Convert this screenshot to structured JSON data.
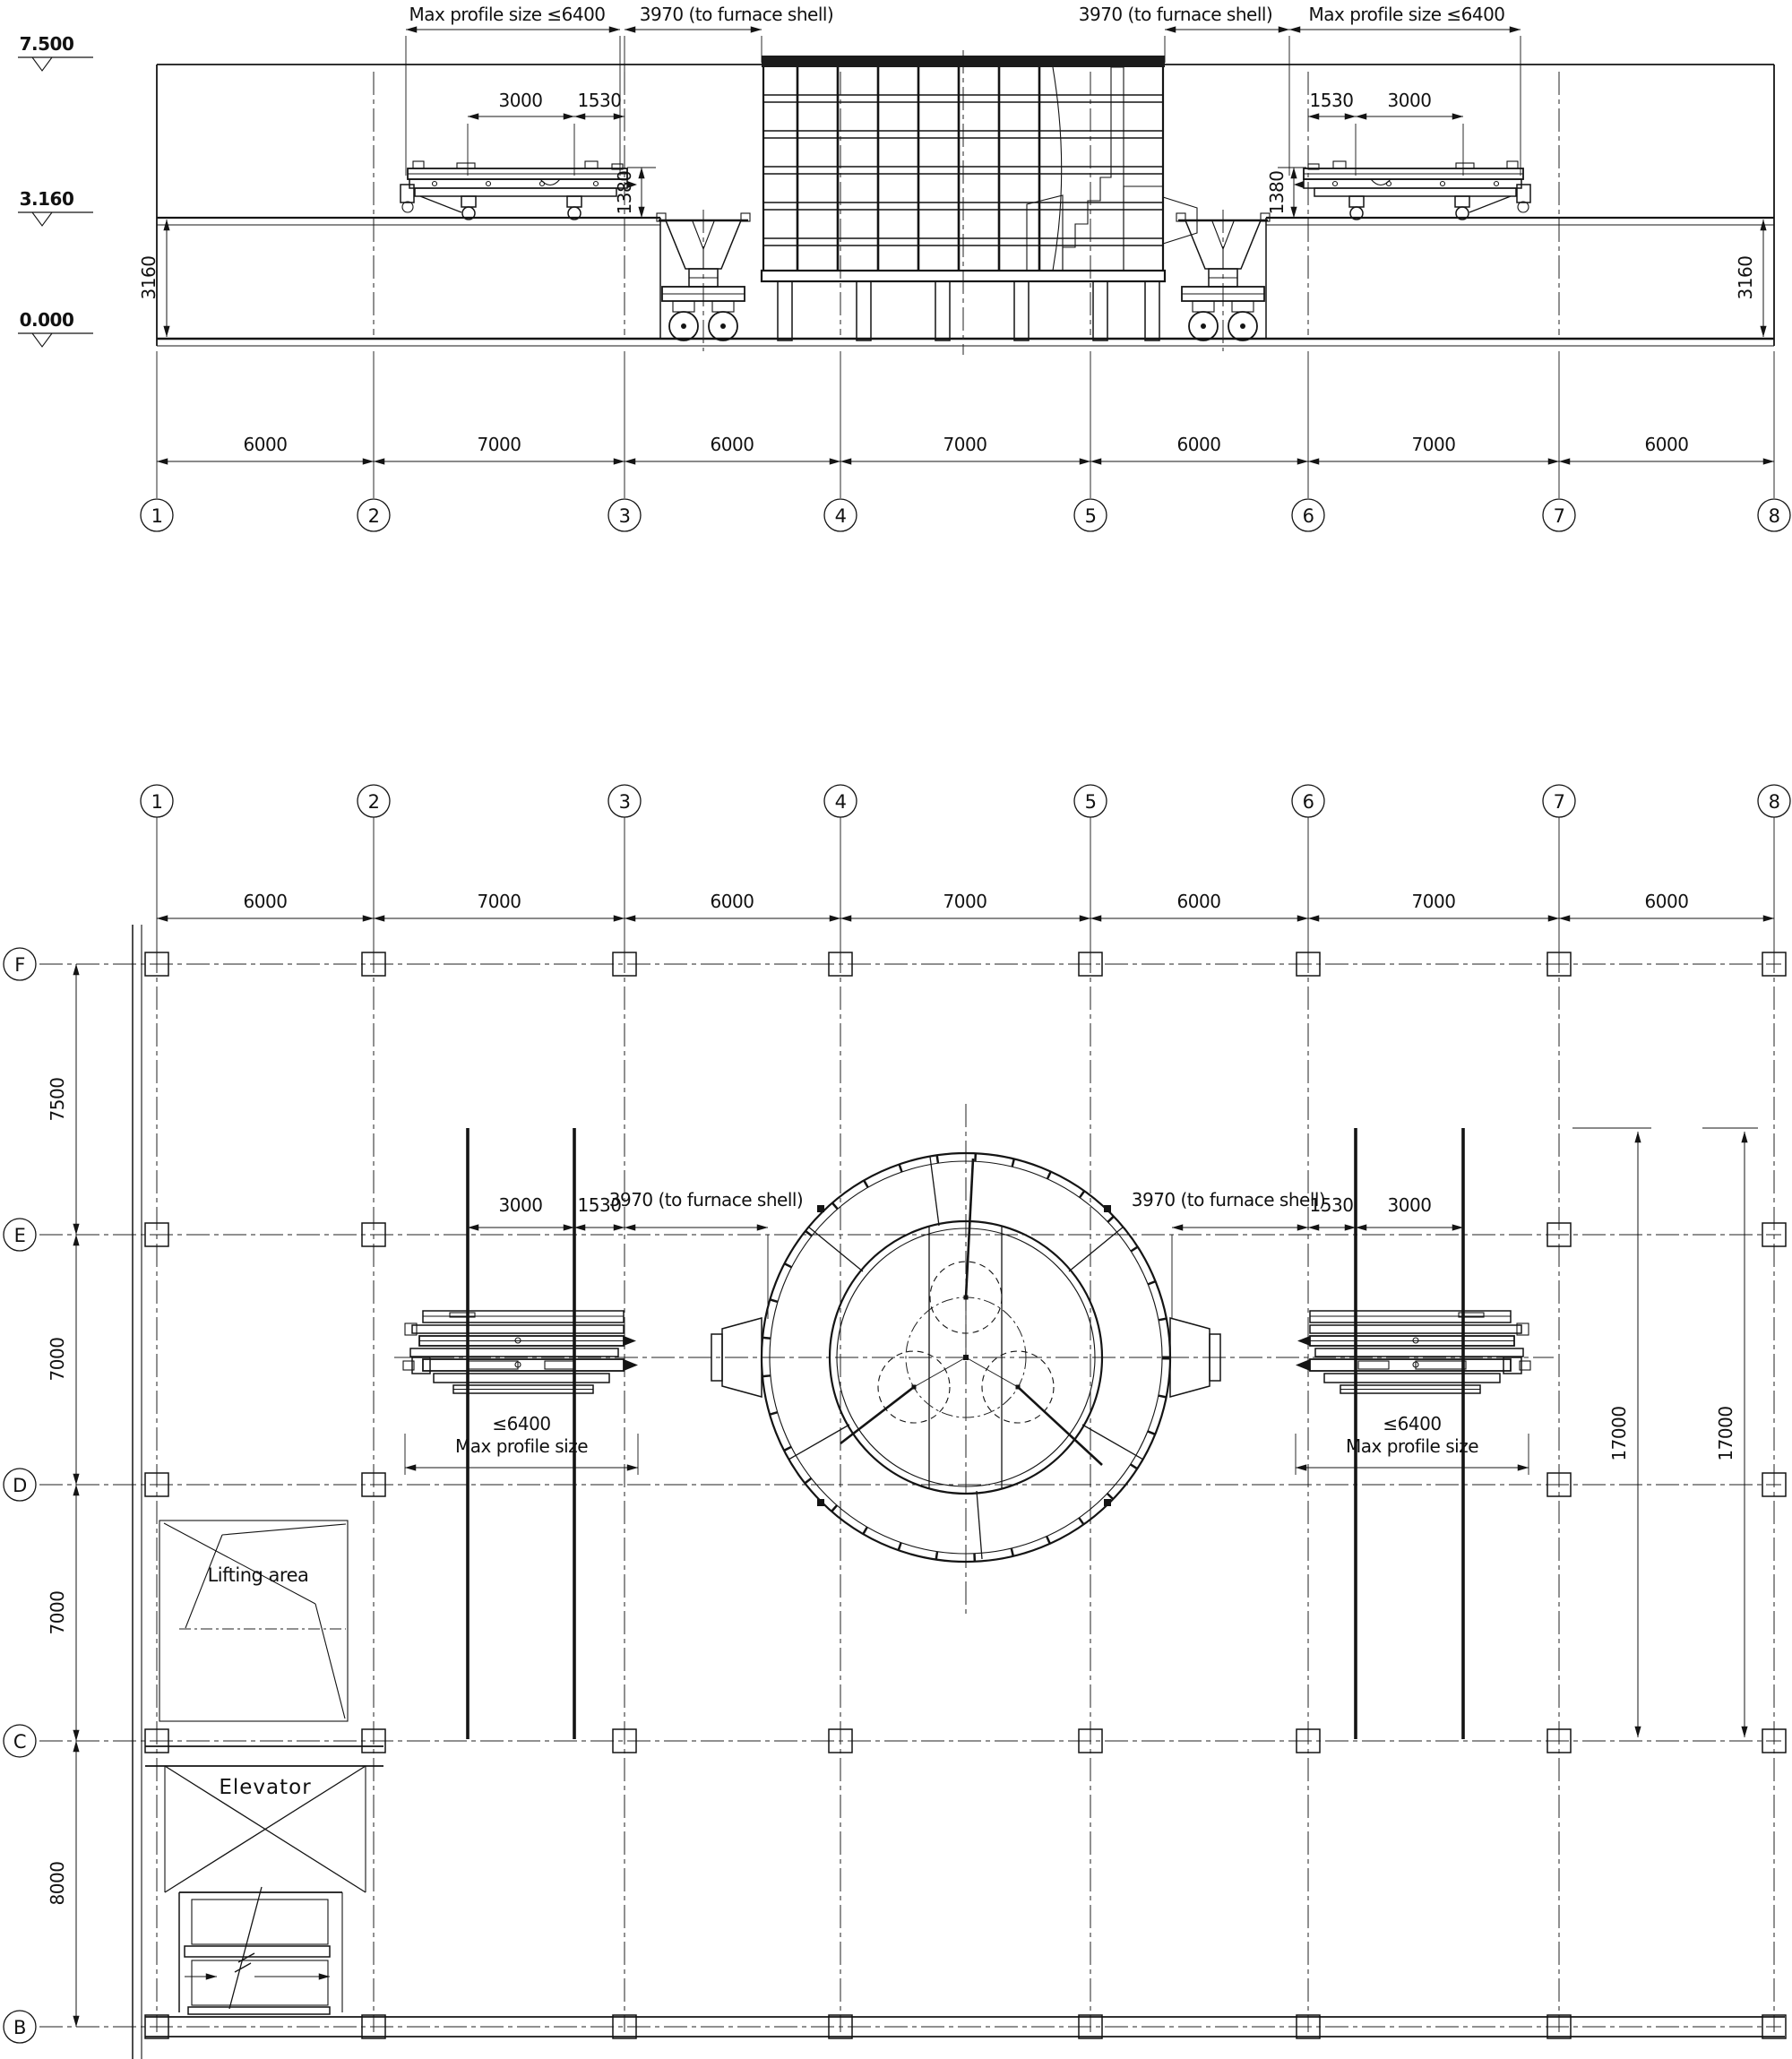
{
  "elevation": {
    "levels": [
      "7.500",
      "3.160",
      "0.000"
    ],
    "top_dims": [
      "Max profile size ≤6400",
      "3970 (to furnace shell)",
      "3970 (to furnace shell)",
      "Max profile size ≤6400"
    ],
    "machine_dims_left": [
      "3000",
      "1530"
    ],
    "machine_dims_right": [
      "1530",
      "3000"
    ],
    "machine_height_dims": [
      "1380",
      "1380"
    ],
    "floor_height_dims": [
      "3160",
      "3160"
    ],
    "bay_dims": [
      "6000",
      "7000",
      "6000",
      "7000",
      "6000",
      "7000",
      "6000"
    ],
    "grids": [
      "1",
      "2",
      "3",
      "4",
      "5",
      "6",
      "7",
      "8"
    ]
  },
  "plan": {
    "grids": [
      "1",
      "2",
      "3",
      "4",
      "5",
      "6",
      "7",
      "8"
    ],
    "bay_dims": [
      "6000",
      "7000",
      "6000",
      "7000",
      "6000",
      "7000",
      "6000"
    ],
    "rows": [
      "F",
      "E",
      "D",
      "C",
      "B"
    ],
    "row_dims": [
      "7500",
      "7000",
      "7000",
      "8000"
    ],
    "left_machine": {
      "dims": [
        "3000",
        "1530"
      ],
      "to_furnace": "3970 (to furnace shell)",
      "max_profile": [
        "≤6400",
        "Max profile size"
      ]
    },
    "right_machine": {
      "dims": [
        "1530",
        "3000"
      ],
      "to_furnace": "3970 (to furnace shell)",
      "max_profile": [
        "≤6400",
        "Max profile size"
      ]
    },
    "rail_dims": [
      "17000",
      "17000"
    ],
    "areas": {
      "lifting": "Lifting area",
      "elevator": "Elevator"
    }
  }
}
